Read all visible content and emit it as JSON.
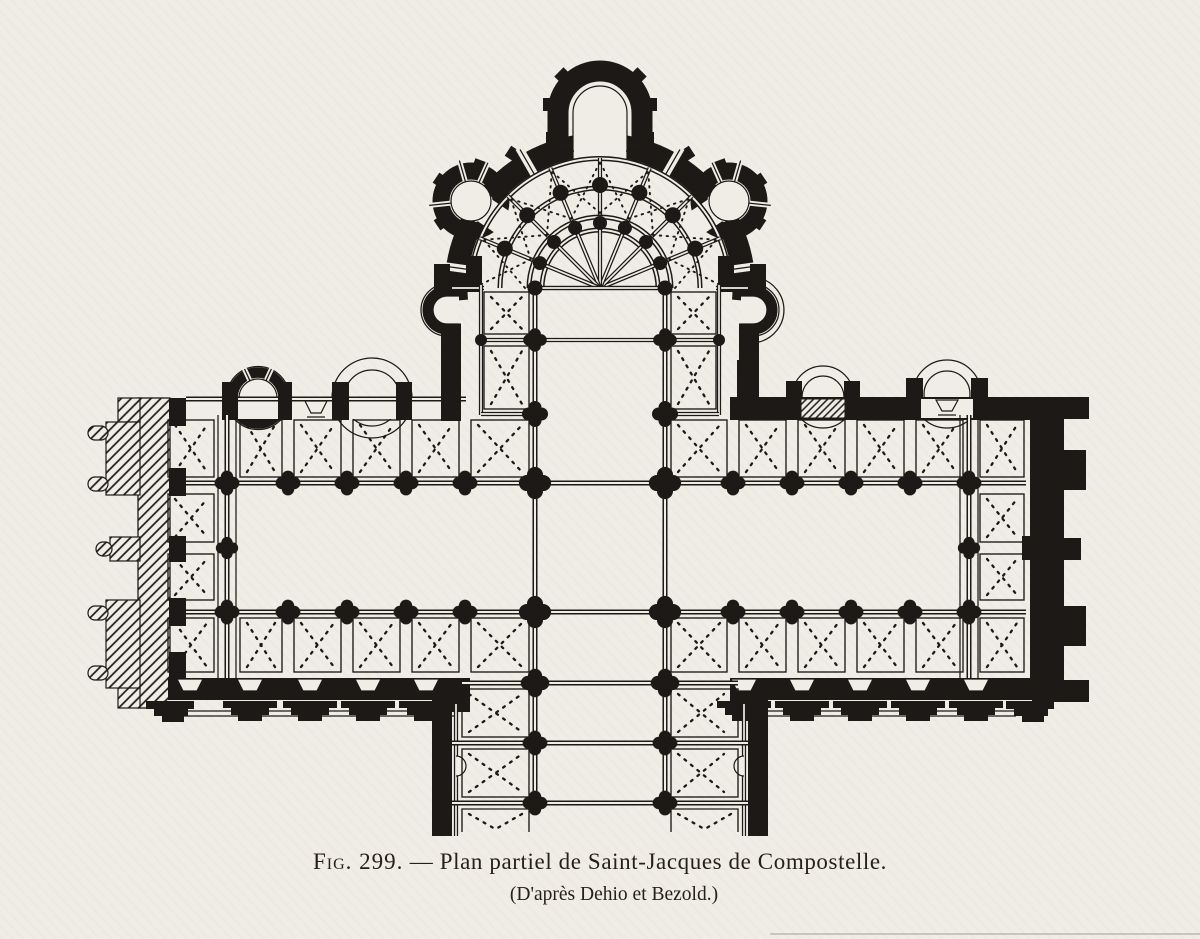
{
  "figure": {
    "caption": {
      "label": "Fig. 299.",
      "dash": "—",
      "title": "Plan partiel de Saint-Jacques de Compostelle.",
      "source": "(D'après Dehio et Bezold.)"
    },
    "subject": "Saint-Jacques de Compostelle",
    "credit": "Dehio et Bezold"
  },
  "colors": {
    "paper": "#f0ede7",
    "ink": "#1c1916"
  }
}
